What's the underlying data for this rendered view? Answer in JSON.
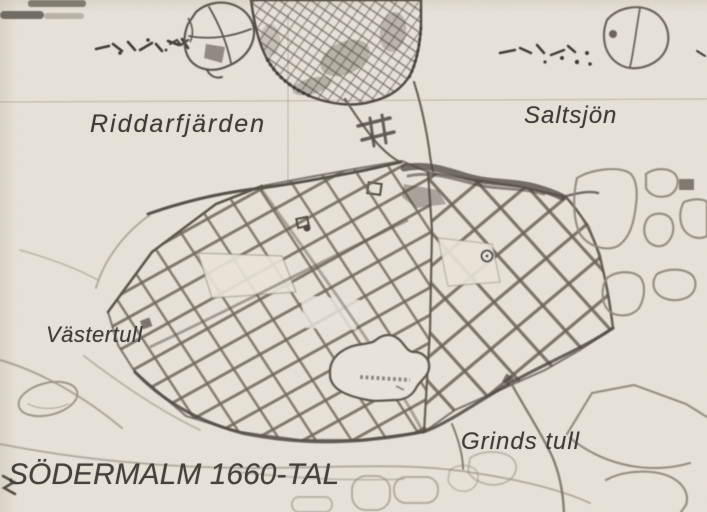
{
  "map": {
    "title": "SÖDERMALM 1660-TAL",
    "labels": {
      "riddarfjarden": "Riddarfjärden",
      "saltsjon": "Saltsjön",
      "vastertull": "Västertull",
      "grinds_tull": "Grinds tull"
    },
    "colors": {
      "paper": "#e8e3d8",
      "map_ink": "#5c564c",
      "dark_ink": "#4c463f",
      "faint_ink": "#9d968a",
      "label_ink": "#3e3c38"
    }
  }
}
